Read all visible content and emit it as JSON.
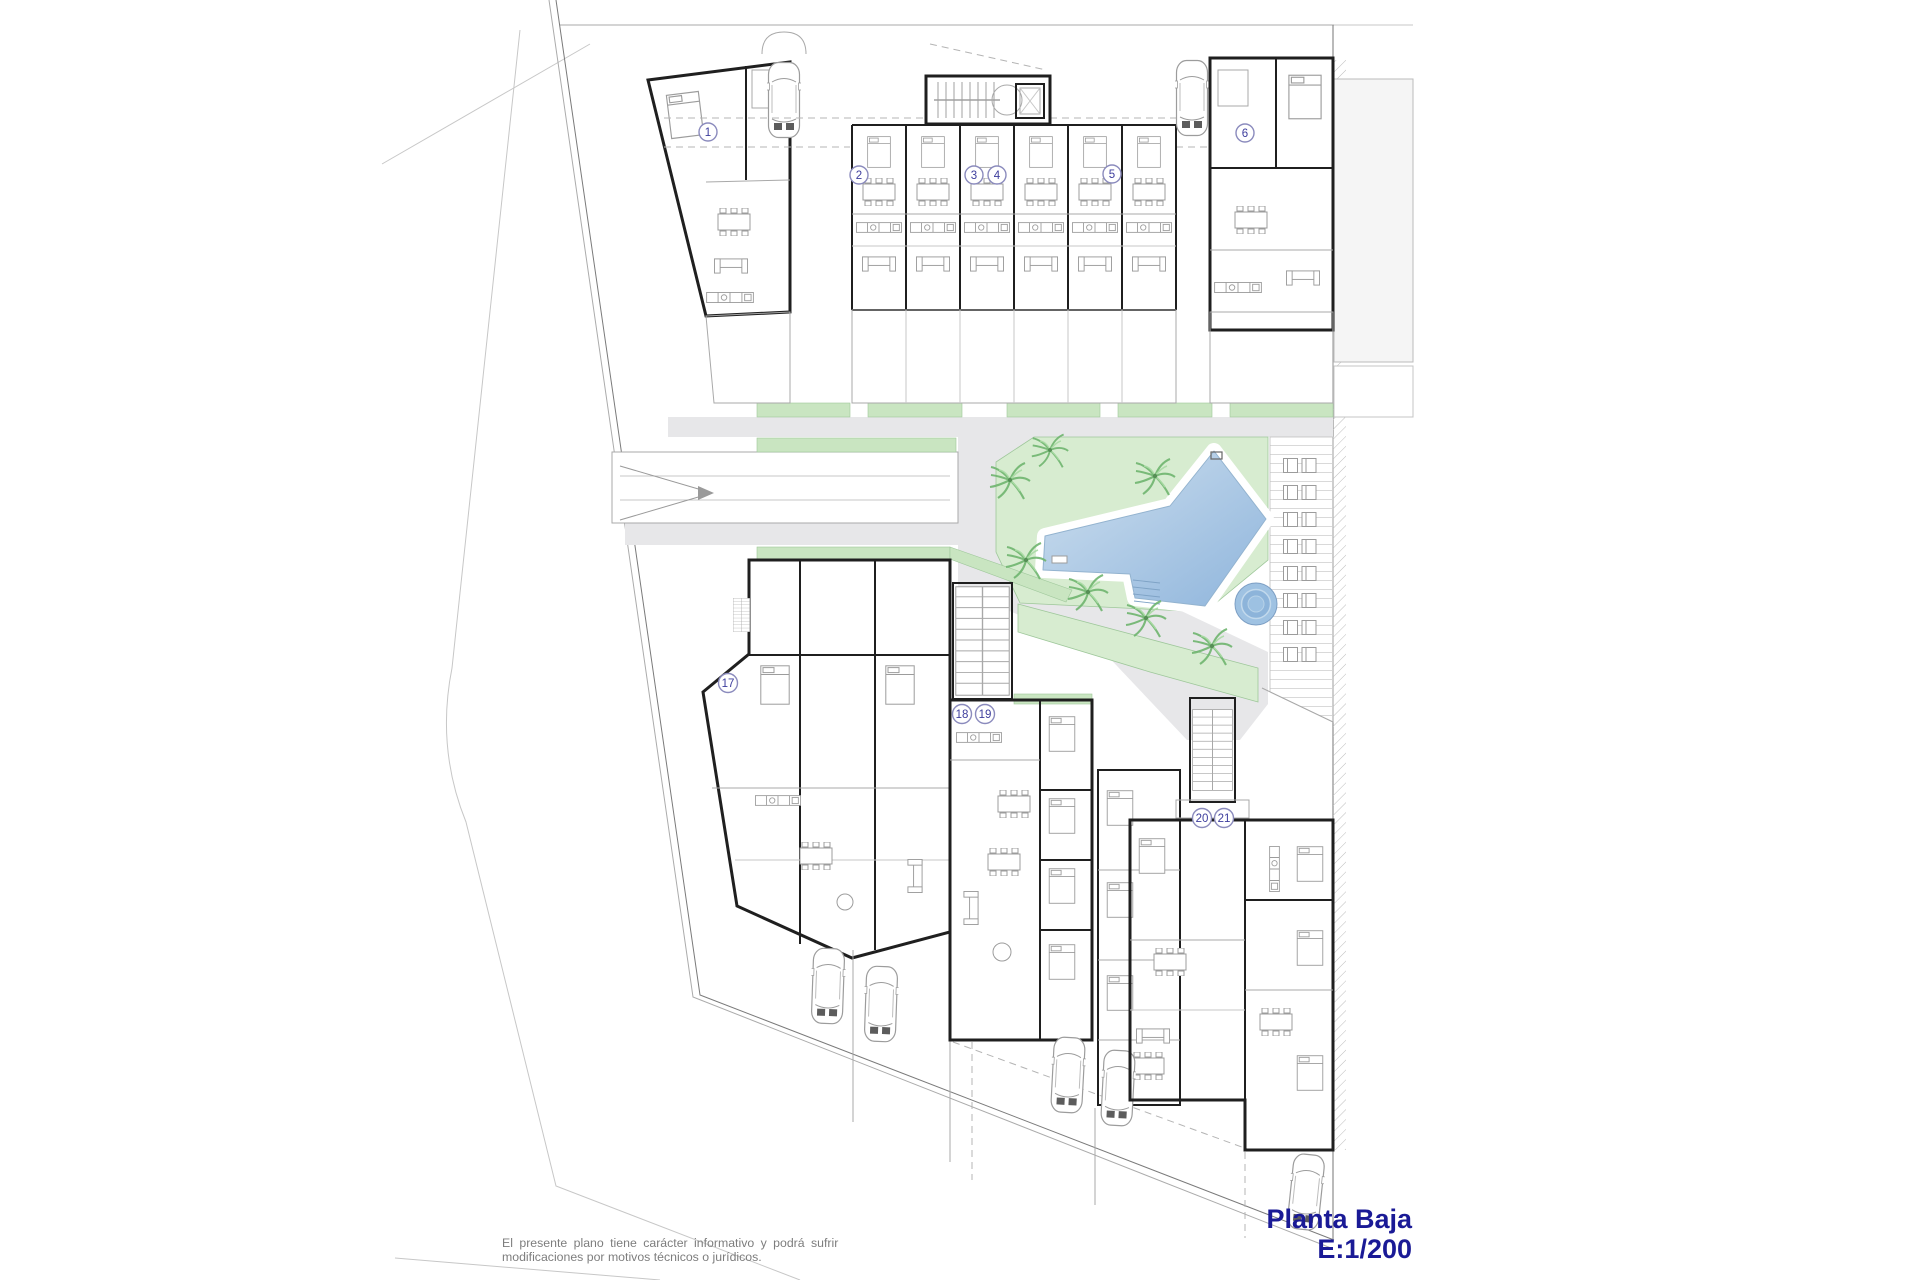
{
  "plan": {
    "floor_title": "Planta Baja",
    "scale_label": "E:1/200",
    "disclaimer": {
      "line1": "El presente plano tiene carácter informativo y podrá sufrir",
      "line2": "modificaciones por motivos técnicos o jurídicos."
    },
    "units": [
      "1",
      "2",
      "3",
      "4",
      "5",
      "6",
      "17",
      "18",
      "19",
      "20",
      "21"
    ],
    "colors": {
      "title_navy": "#1a1a96",
      "unit_label_blue": "#3d3d9d",
      "garden_green": "#d7ecd0",
      "strip_green": "#c9e5c1",
      "palm_green": "#6fb56f",
      "pool_light": "#cfe0ef",
      "pool_dark": "#8fb5dc",
      "spa_blue": "#9fc2e2",
      "walkway_gray": "#e7e7e9",
      "neighbor_gray": "#f5f5f5",
      "wall_black": "#1f1f1f"
    },
    "icons": {
      "car": "car-icon",
      "palm_tree": "palm-tree-icon",
      "sun_lounger": "sun-lounger-icon",
      "staircase": "staircase-icon",
      "elevator": "elevator-icon",
      "swimming_pool": "pool-shape",
      "spa": "spa-circle",
      "ramp_arrow": "ramp-arrow-icon"
    }
  }
}
